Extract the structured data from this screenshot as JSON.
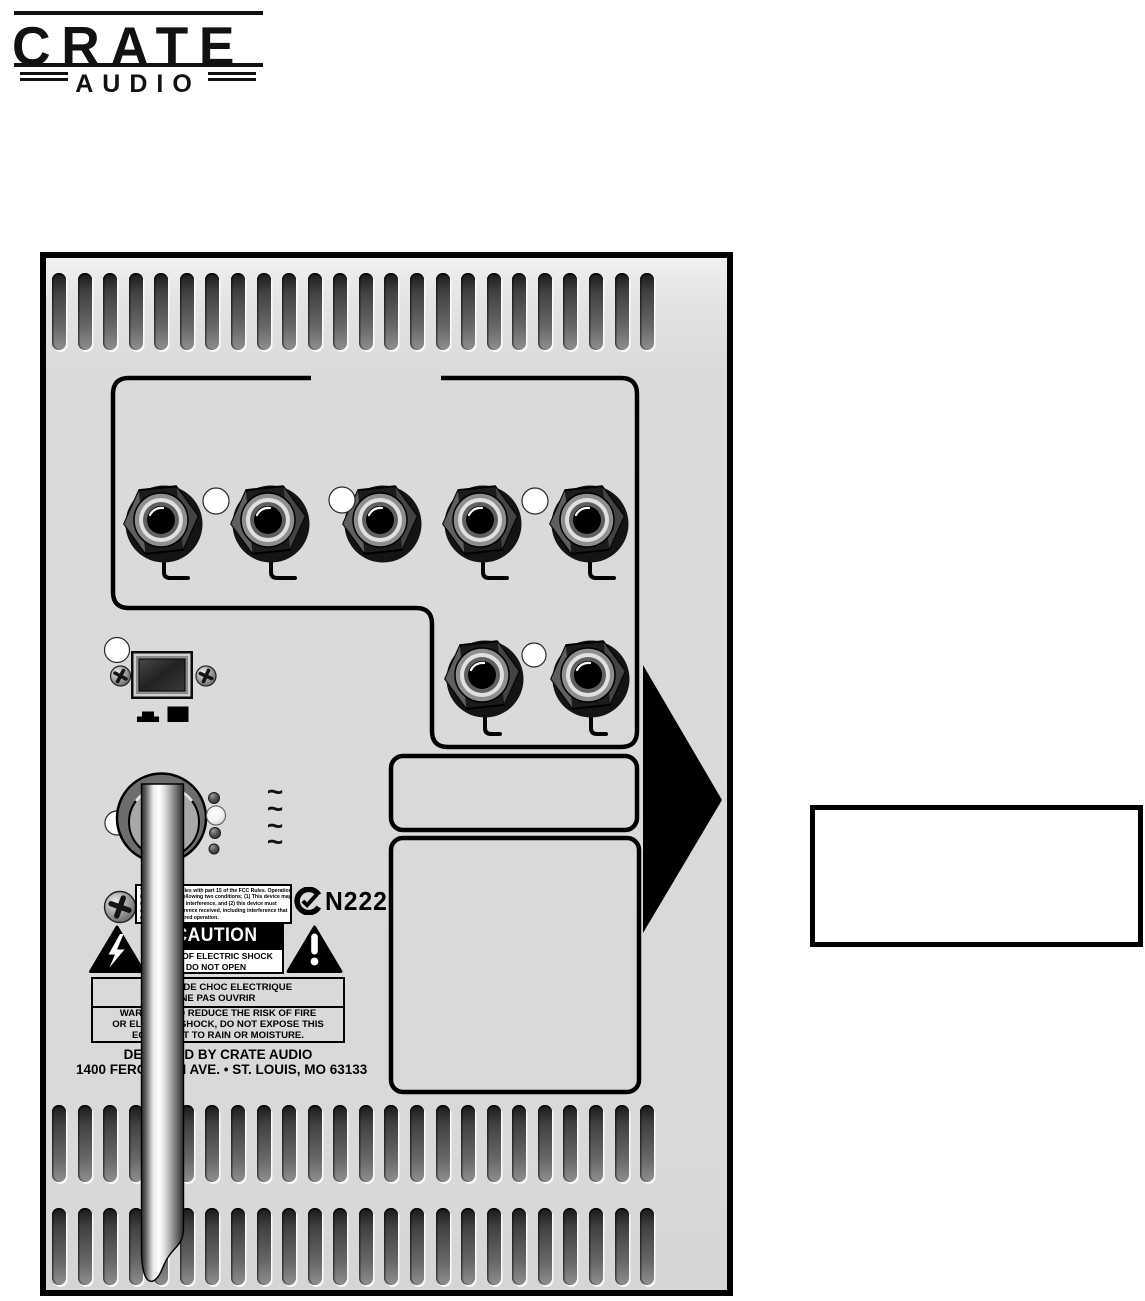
{
  "logo": {
    "brand": "CRATE",
    "subbrand": "AUDIO"
  },
  "panel": {
    "vents": {
      "rows": 3,
      "slots_per_row": 24
    },
    "jacks": {
      "row1_count": 5,
      "row2_count": 2
    },
    "ac_symbol": "~",
    "fcc_label": {
      "lines": [
        "This device complies with part 15 of the FCC Rules. Operation",
        "is subject to the following two conditions: (1) This device may",
        "not cause harmful interference, and (2) this device must",
        "accept any interference received, including interference that",
        "may cause undesired operation."
      ]
    },
    "ctick_code": "N222",
    "caution": {
      "title": "CAUTION",
      "risk_lines": [
        "RISK OF ELECTRIC SHOCK",
        "DO NOT OPEN"
      ],
      "french_lines": [
        "RISQUE DE CHOC ELECTRIQUE",
        "NE PAS OUVRIR"
      ],
      "warning_lines": [
        "WARNING: TO REDUCE THE RISK OF FIRE",
        "OR ELECTRIC SHOCK, DO NOT EXPOSE THIS",
        "EQUIPMENT TO RAIN OR MOISTURE."
      ]
    },
    "maker_line": "DESIGNED BY CRATE AUDIO",
    "address_line": "1400 FERGUSON AVE. • ST. LOUIS, MO 63133"
  },
  "colors": {
    "panel_bg": "#d9d9d9",
    "outline": "#000000",
    "label_bg": "#ffffff",
    "vent": "#4a4a4a"
  }
}
